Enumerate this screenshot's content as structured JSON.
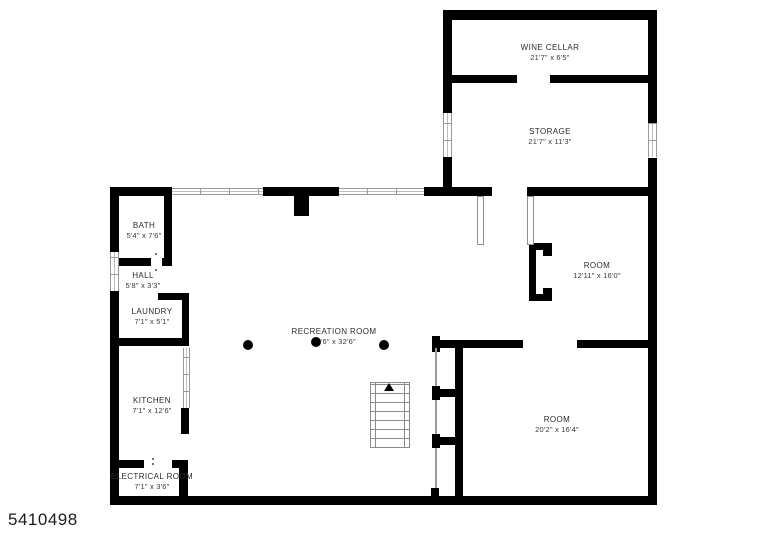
{
  "title": "Basement floor plan",
  "footer": {
    "plan_id": "5410498"
  },
  "colors": {
    "wall": "#000000",
    "background": "#ffffff",
    "window_line": "#9a9a9a",
    "label_text": "#2b2b2b"
  },
  "rooms": [
    {
      "name": "WINE CELLAR",
      "dims": "21'7\" x 6'5\""
    },
    {
      "name": "STORAGE",
      "dims": "21'7\" x 11'3\""
    },
    {
      "name": "ROOM",
      "dims": "12'11\" x 16'0\""
    },
    {
      "name": "ROOM",
      "dims": "20'2\" x 16'4\""
    },
    {
      "name": "BATH",
      "dims": "5'4\" x 7'6\""
    },
    {
      "name": "HALL",
      "dims": "5'8\" x 3'3\""
    },
    {
      "name": "LAUNDRY",
      "dims": "7'1\" x 5'1\""
    },
    {
      "name": "KITCHEN",
      "dims": "7'1\" x 12'6\""
    },
    {
      "name": "ELECTRICAL ROOM",
      "dims": "7'1\" x 3'6\""
    },
    {
      "name": "RECREATION ROOM",
      "dims": "26'6\" x 32'6\""
    }
  ],
  "features": {
    "stairs": "stairs-up",
    "columns": 3,
    "windows": 6
  }
}
